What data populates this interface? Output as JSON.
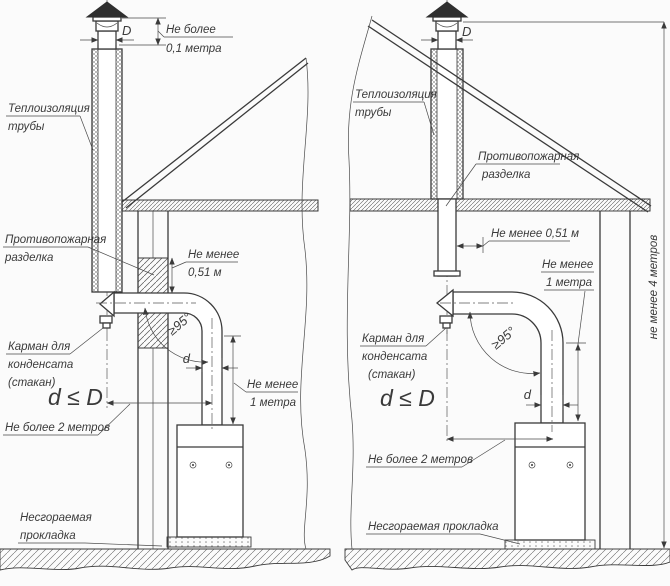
{
  "page": {
    "background": "#fbfbfb",
    "ink": "#3a3a3a",
    "figure_kind": "chimney installation technical drawing, two variants"
  },
  "left": {
    "labels": {
      "cap_clearance": [
        "Не более",
        "0,1 метра"
      ],
      "diameter": "D",
      "pipe_insulation": [
        "Теплоизоляция",
        "трубы"
      ],
      "fire_cut": [
        "Противопожарная",
        "разделка"
      ],
      "fire_cut_min": [
        "Не менее",
        "0,51 м"
      ],
      "condensate": [
        "Карман для",
        "конденсата",
        "(стакан)"
      ],
      "formula": "d ≤ D",
      "max_2m": "Не более 2 метров",
      "angle": "≥95°",
      "small_d": "d",
      "min_1m": [
        "Не менее",
        "1 метра"
      ],
      "pad": [
        "Несгораемая",
        "прокладка"
      ]
    }
  },
  "right": {
    "labels": {
      "diameter": "D",
      "pipe_insulation": [
        "Теплоизоляция",
        "трубы"
      ],
      "fire_cut": [
        "Противопожарная",
        "разделка"
      ],
      "fire_cut_min": "Не менее 0,51 м",
      "min_1m": [
        "Не менее",
        "1 метра"
      ],
      "condensate": [
        "Карман для",
        "конденсата",
        "(стакан)"
      ],
      "formula": "d ≤ D",
      "angle": "≥95°",
      "small_d": "d",
      "max_2m": "Не более 2 метров",
      "pad": "Несгораемая прокладка",
      "min_4m": "не менее 4 метров"
    }
  }
}
